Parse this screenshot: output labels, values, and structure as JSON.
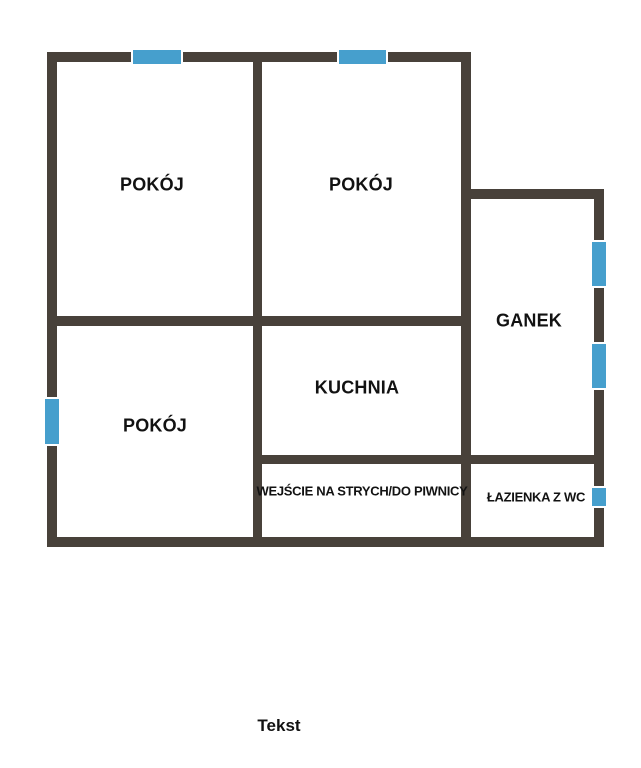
{
  "colors": {
    "background": "#ffffff",
    "wall": "#48413a",
    "window_blue": "#469fcd",
    "window_frame": "#ffffff",
    "label_text": "#121212"
  },
  "rooms": [
    {
      "id": "pokoj-top-left",
      "label": "POKÓJ",
      "cx": 152,
      "cy": 185,
      "size": "large"
    },
    {
      "id": "pokoj-top-middle",
      "label": "POKÓJ",
      "cx": 361,
      "cy": 185,
      "size": "large"
    },
    {
      "id": "ganek",
      "label": "GANEK",
      "cx": 529,
      "cy": 321,
      "size": "large"
    },
    {
      "id": "kuchnia",
      "label": "KUCHNIA",
      "cx": 357,
      "cy": 388,
      "size": "large"
    },
    {
      "id": "pokoj-bottom-left",
      "label": "POKÓJ",
      "cx": 155,
      "cy": 426,
      "size": "large"
    },
    {
      "id": "wejscie",
      "label": "WEJŚCIE NA STRYCH/DO PIWNICY",
      "cx": 362,
      "cy": 491,
      "size": "small"
    },
    {
      "id": "lazienka",
      "label": "ŁAZIENKA Z WC",
      "cx": 536,
      "cy": 497,
      "size": "small"
    }
  ],
  "caption": {
    "label": "Tekst",
    "cx": 279,
    "cy": 726
  },
  "geometry": {
    "walls": [
      {
        "name": "outer-top-wall",
        "x": 47,
        "y": 52,
        "w": 424,
        "h": 10
      },
      {
        "name": "outer-left-wall",
        "x": 47,
        "y": 52,
        "w": 10,
        "h": 494
      },
      {
        "name": "outer-bottom-wall",
        "x": 47,
        "y": 537,
        "w": 557,
        "h": 10
      },
      {
        "name": "outer-right-wall",
        "x": 594,
        "y": 189,
        "w": 10,
        "h": 358
      },
      {
        "name": "porch-top-wall",
        "x": 461,
        "y": 189,
        "w": 143,
        "h": 10
      },
      {
        "name": "partition-vertical-left",
        "x": 253,
        "y": 52,
        "w": 9,
        "h": 494
      },
      {
        "name": "partition-vertical-right",
        "x": 461,
        "y": 52,
        "w": 10,
        "h": 494
      },
      {
        "name": "partition-horizontal-upper",
        "x": 47,
        "y": 316,
        "w": 424,
        "h": 10
      },
      {
        "name": "partition-horizontal-lower",
        "x": 253,
        "y": 455,
        "w": 351,
        "h": 9
      }
    ],
    "windows": [
      {
        "name": "window-top-left-room",
        "dir": "h",
        "x": 131,
        "y": 50,
        "w": 52,
        "h": 14
      },
      {
        "name": "window-top-middle-room",
        "dir": "h",
        "x": 337,
        "y": 50,
        "w": 51,
        "h": 14
      },
      {
        "name": "window-left-bottom-room",
        "dir": "v",
        "x": 45,
        "y": 397,
        "w": 14,
        "h": 49
      },
      {
        "name": "window-porch-upper",
        "dir": "v",
        "x": 592,
        "y": 240,
        "w": 14,
        "h": 48
      },
      {
        "name": "window-porch-lower",
        "dir": "v",
        "x": 592,
        "y": 342,
        "w": 14,
        "h": 48
      },
      {
        "name": "window-bathroom",
        "dir": "v",
        "x": 592,
        "y": 486,
        "w": 14,
        "h": 22
      }
    ]
  }
}
